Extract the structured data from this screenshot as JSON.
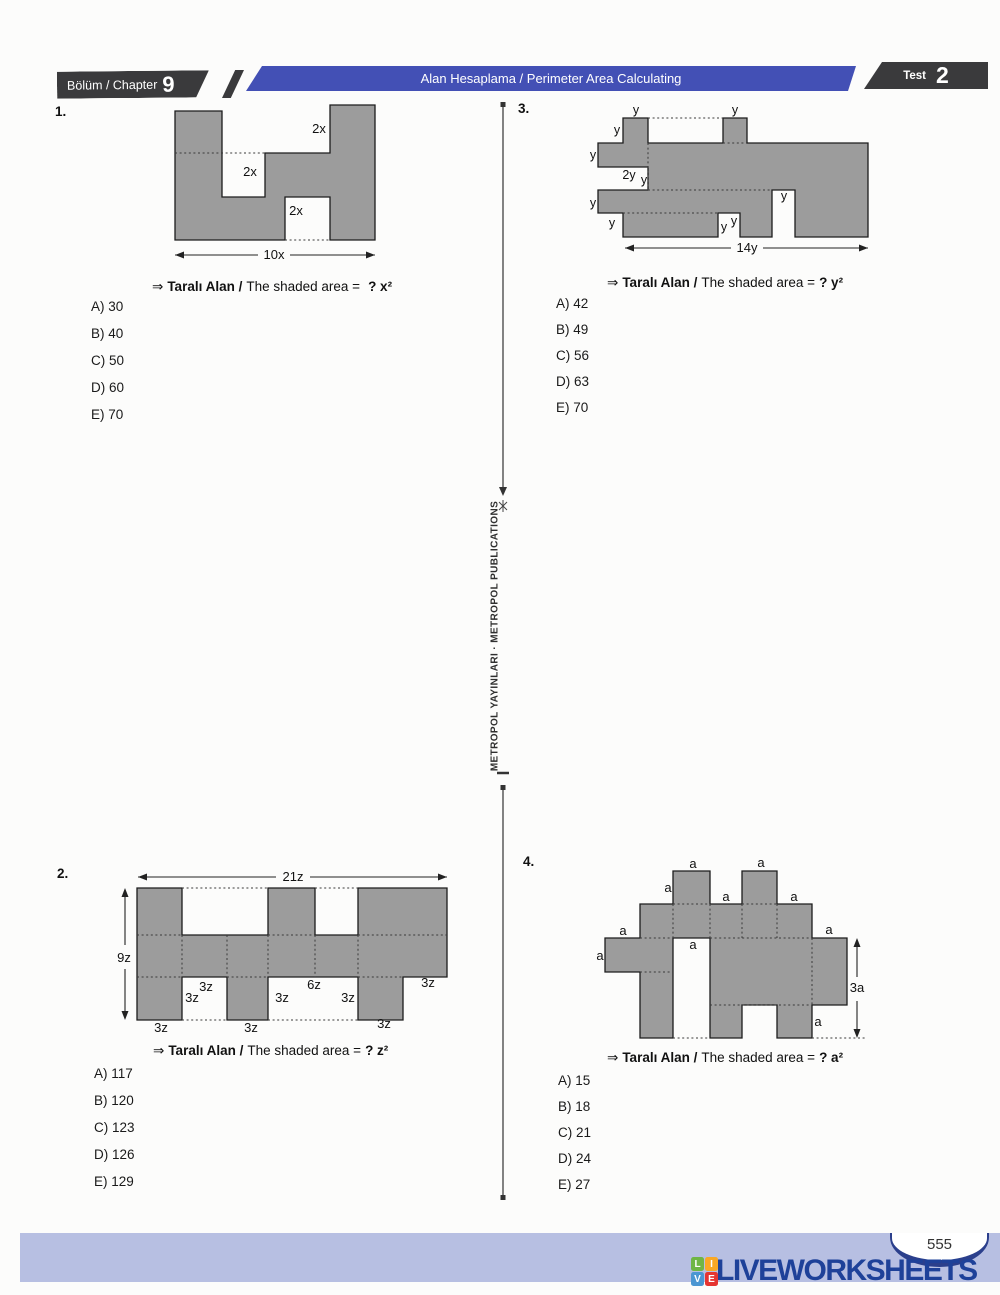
{
  "header": {
    "chapter_label": "Bölüm / Chapter",
    "chapter_number": "9",
    "title": "Alan Hesaplama / Perimeter Area Calculating",
    "test_label": "Test",
    "test_number": "2"
  },
  "divider": {
    "text": "METROPOL YAYINLARI · METROPOL PUBLICATIONS"
  },
  "questions": {
    "q1": {
      "number": "1.",
      "prompt": {
        "arrow": "⇒",
        "label_tr": "Taralı Alan /",
        "label_en": "The shaded area =",
        "answer": "? x²"
      },
      "options": [
        "A) 30",
        "B) 40",
        "C) 50",
        "D) 60",
        "E) 70"
      ],
      "diagram": {
        "labels": [
          "2x",
          "2x",
          "2x"
        ],
        "width_label": "10x"
      }
    },
    "q2": {
      "number": "2.",
      "prompt": {
        "arrow": "⇒",
        "label_tr": "Taralı Alan /",
        "label_en": "The shaded area =",
        "answer": "? z²"
      },
      "options": [
        "A) 117",
        "B) 120",
        "C) 123",
        "D) 126",
        "E) 129"
      ],
      "diagram": {
        "labels": [
          "3z",
          "3z",
          "3z",
          "6z",
          "3z",
          "3z",
          "3z",
          "3z",
          "3z"
        ],
        "width_label": "21z",
        "height_label": "9z"
      }
    },
    "q3": {
      "number": "3.",
      "prompt": {
        "arrow": "⇒",
        "label_tr": "Taralı Alan /",
        "label_en": "The shaded area =",
        "answer": "? y²"
      },
      "options": [
        "A) 42",
        "B) 49",
        "C) 56",
        "D) 63",
        "E) 70"
      ],
      "diagram": {
        "labels": [
          "y",
          "y",
          "y",
          "y",
          "2y",
          "y",
          "y",
          "y",
          "y",
          "y",
          "y"
        ],
        "width_label": "14y"
      }
    },
    "q4": {
      "number": "4.",
      "prompt": {
        "arrow": "⇒",
        "label_tr": "Taralı Alan /",
        "label_en": "The shaded area =",
        "answer": "? a²"
      },
      "options": [
        "A) 15",
        "B) 18",
        "C) 21",
        "D) 24",
        "E) 27"
      ],
      "diagram": {
        "labels": [
          "a",
          "a",
          "a",
          "a",
          "a",
          "a",
          "a",
          "a",
          "a",
          "a"
        ],
        "height_label": "3a"
      }
    }
  },
  "footer": {
    "page_number": "555",
    "brand": "LIVEWORKSHEETS",
    "brand_icon_letters": [
      "L",
      "I",
      "V",
      "E"
    ]
  },
  "colors": {
    "banner_blue": "#4350b5",
    "header_dark": "#3a3a3c",
    "shape_gray": "#9c9c9c",
    "footer_band": "#b7bfe2",
    "brand_blue": "#1e4199",
    "icon_green": "#6fb644",
    "icon_orange": "#f9a825",
    "icon_blue": "#4b96d2",
    "icon_red": "#e53531"
  }
}
